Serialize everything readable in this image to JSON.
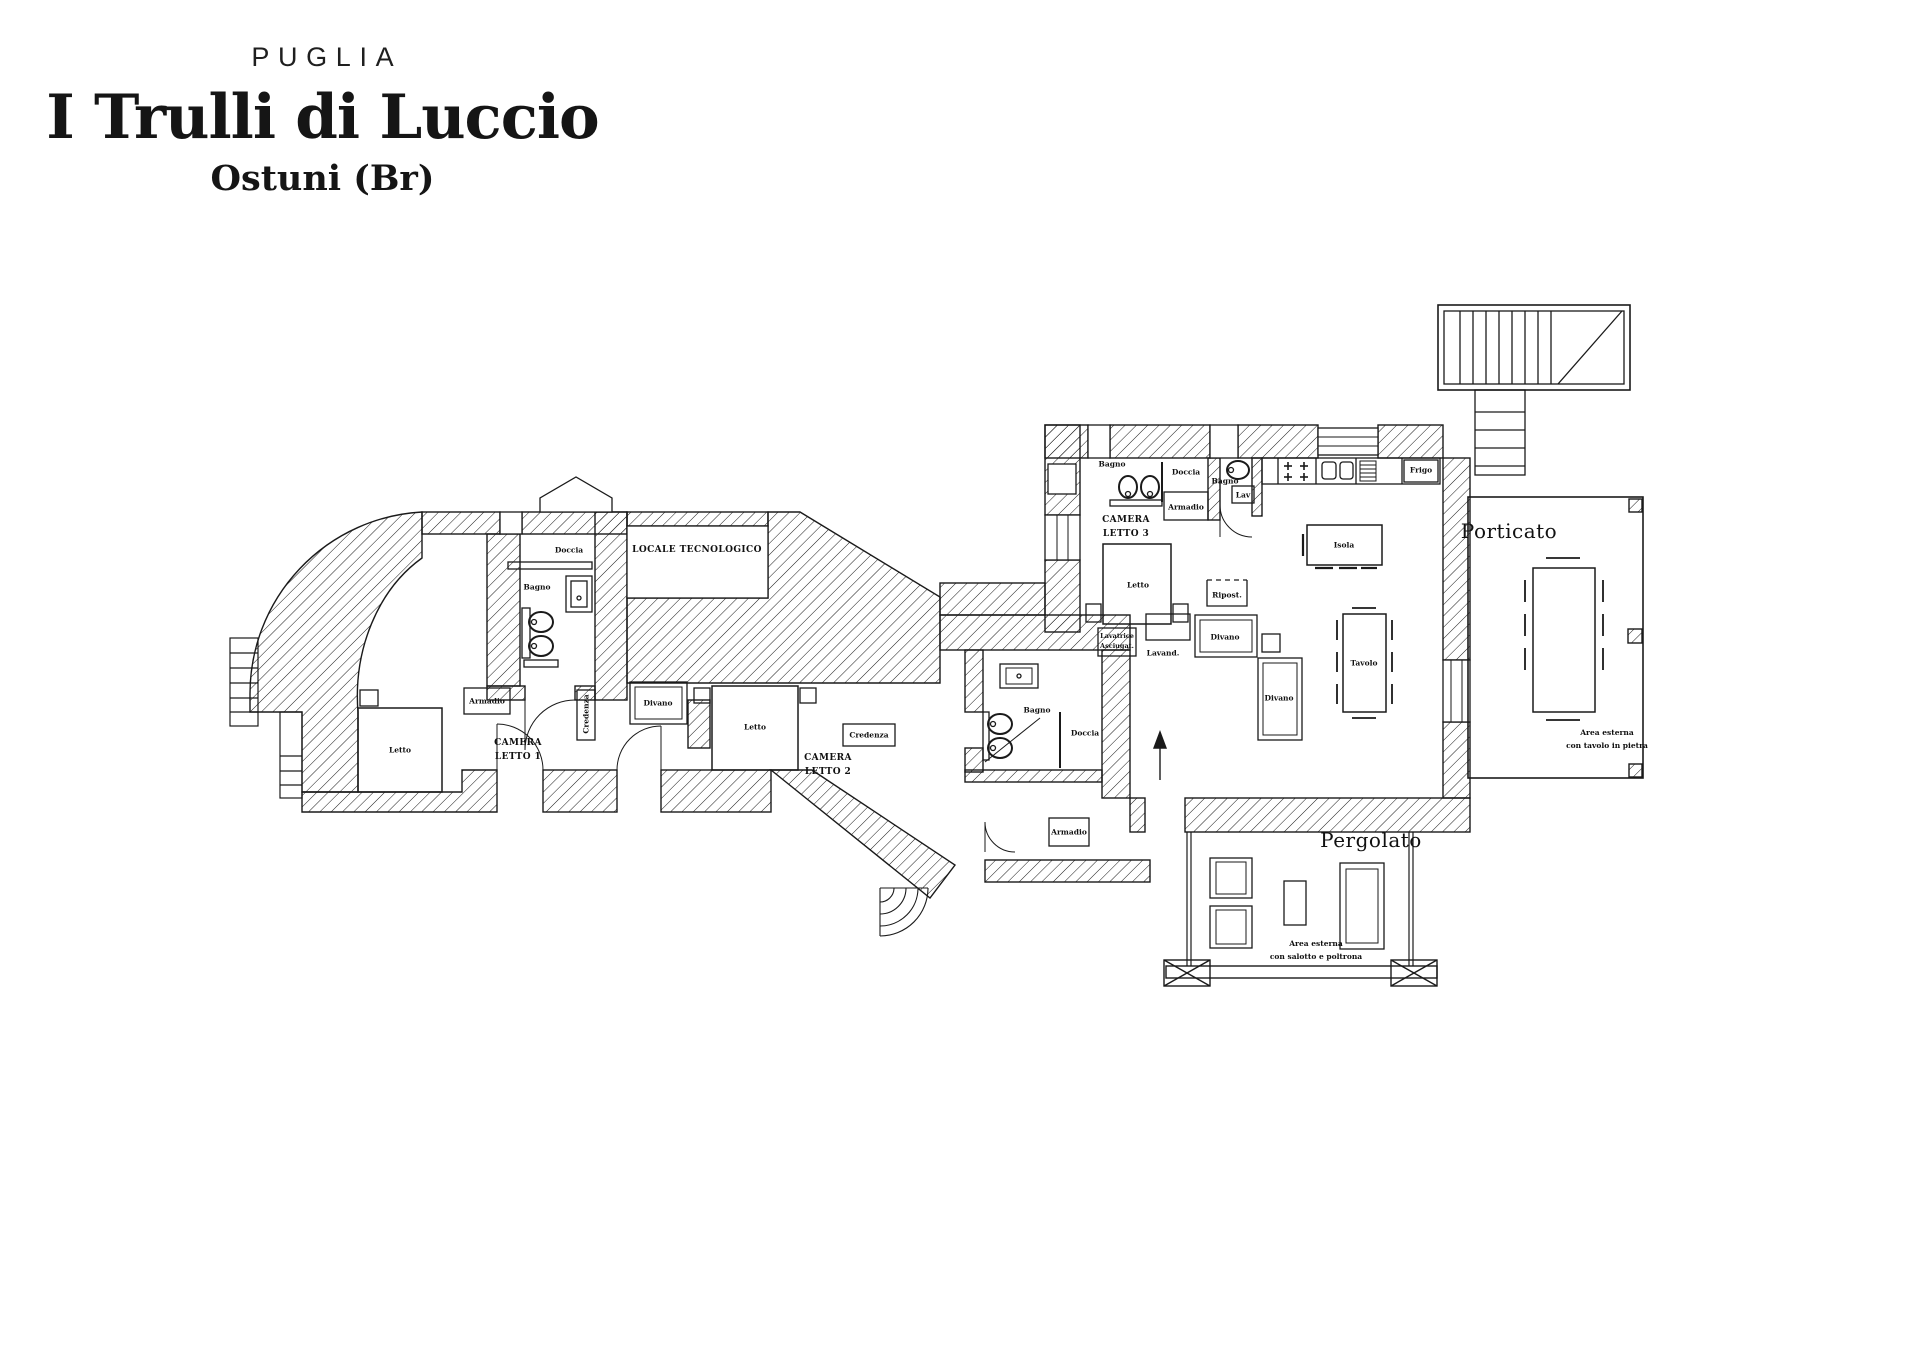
{
  "title": {
    "region": "PUGLIA",
    "name": "I Trulli di Luccio",
    "location": "Ostuni (Br)"
  },
  "colors": {
    "ink": "#1a1a1a",
    "paper": "#ffffff"
  },
  "plan": {
    "labels": [
      {
        "name": "room-label-camera-letto-1",
        "text": "CAMERA\nLETTO 1",
        "x": 518,
        "y": 751,
        "cls": "room"
      },
      {
        "name": "room-label-camera-letto-2",
        "text": "CAMERA\nLETTO 2",
        "x": 828,
        "y": 766,
        "cls": "room"
      },
      {
        "name": "room-label-camera-letto-3",
        "text": "CAMERA\nLETTO 3",
        "x": 1126,
        "y": 528,
        "cls": "room"
      },
      {
        "name": "room-label-locale-tecnologico",
        "text": "LOCALE TECNOLOGICO",
        "x": 697,
        "y": 551,
        "cls": "room"
      },
      {
        "name": "room-label-porticato",
        "text": "Porticato",
        "x": 1509,
        "y": 531,
        "cls": "big"
      },
      {
        "name": "room-label-pergolato",
        "text": "Pergolato",
        "x": 1371,
        "y": 840,
        "cls": "big"
      },
      {
        "name": "note-label-area-porticato",
        "text": "Area esterna\ncon tavolo in pietra",
        "x": 1607,
        "y": 739,
        "cls": "note"
      },
      {
        "name": "note-label-area-pergolato",
        "text": "Area esterna\ncon salotto e poltrona",
        "x": 1316,
        "y": 950,
        "cls": "note"
      },
      {
        "name": "item-label-doccia-bagno1",
        "text": "Doccia",
        "x": 569,
        "y": 550,
        "cls": "item"
      },
      {
        "name": "item-label-bagno1",
        "text": "Bagno",
        "x": 537,
        "y": 587,
        "cls": "item"
      },
      {
        "name": "item-label-armadio-cl1",
        "text": "Armadio",
        "x": 487,
        "y": 701,
        "cls": "item"
      },
      {
        "name": "item-label-letto-cl1",
        "text": "Letto",
        "x": 400,
        "y": 750,
        "cls": "item"
      },
      {
        "name": "item-label-credenza-cl1",
        "text": "Credenza",
        "x": 586,
        "y": 714,
        "cls": "item vert"
      },
      {
        "name": "item-label-divano-cl2",
        "text": "Divano",
        "x": 658,
        "y": 703,
        "cls": "item"
      },
      {
        "name": "item-label-letto-cl2",
        "text": "Letto",
        "x": 755,
        "y": 727,
        "cls": "item"
      },
      {
        "name": "item-label-credenza-cl2",
        "text": "Credenza",
        "x": 869,
        "y": 735,
        "cls": "item"
      },
      {
        "name": "item-label-bagno2",
        "text": "Bagno",
        "x": 1037,
        "y": 710,
        "cls": "item"
      },
      {
        "name": "item-label-doccia-bagno2",
        "text": "Doccia",
        "x": 1085,
        "y": 733,
        "cls": "item"
      },
      {
        "name": "item-label-armadio-entry",
        "text": "Armadio",
        "x": 1069,
        "y": 832,
        "cls": "item"
      },
      {
        "name": "item-label-bagno3",
        "text": "Bagno",
        "x": 1112,
        "y": 464,
        "cls": "item"
      },
      {
        "name": "item-label-doccia-bagno3",
        "text": "Doccia",
        "x": 1186,
        "y": 472,
        "cls": "item"
      },
      {
        "name": "item-label-armadio-cl3",
        "text": "Armadio",
        "x": 1186,
        "y": 507,
        "cls": "item"
      },
      {
        "name": "item-label-letto-cl3",
        "text": "Letto",
        "x": 1138,
        "y": 585,
        "cls": "item"
      },
      {
        "name": "item-label-bagno4",
        "text": "Bagno",
        "x": 1225,
        "y": 481,
        "cls": "item"
      },
      {
        "name": "item-label-lav-bagno4",
        "text": "Lav",
        "x": 1243,
        "y": 495,
        "cls": "item"
      },
      {
        "name": "item-label-frigo",
        "text": "Frigo",
        "x": 1421,
        "y": 470,
        "cls": "item"
      },
      {
        "name": "item-label-isola",
        "text": "Isola",
        "x": 1344,
        "y": 545,
        "cls": "item"
      },
      {
        "name": "item-label-tavolo",
        "text": "Tavolo",
        "x": 1364,
        "y": 663,
        "cls": "item"
      },
      {
        "name": "item-label-divano-living-1",
        "text": "Divano",
        "x": 1225,
        "y": 637,
        "cls": "item"
      },
      {
        "name": "item-label-divano-living-2",
        "text": "Divano",
        "x": 1279,
        "y": 698,
        "cls": "item"
      },
      {
        "name": "item-label-ripostiglio",
        "text": "Ripost.",
        "x": 1227,
        "y": 595,
        "cls": "item"
      },
      {
        "name": "item-label-lavatrice",
        "text": "Lavatrice\nAsciugat.",
        "x": 1117,
        "y": 641,
        "cls": "tiny"
      },
      {
        "name": "item-label-lavandino",
        "text": "Lavand.",
        "x": 1163,
        "y": 653,
        "cls": "item"
      }
    ]
  }
}
